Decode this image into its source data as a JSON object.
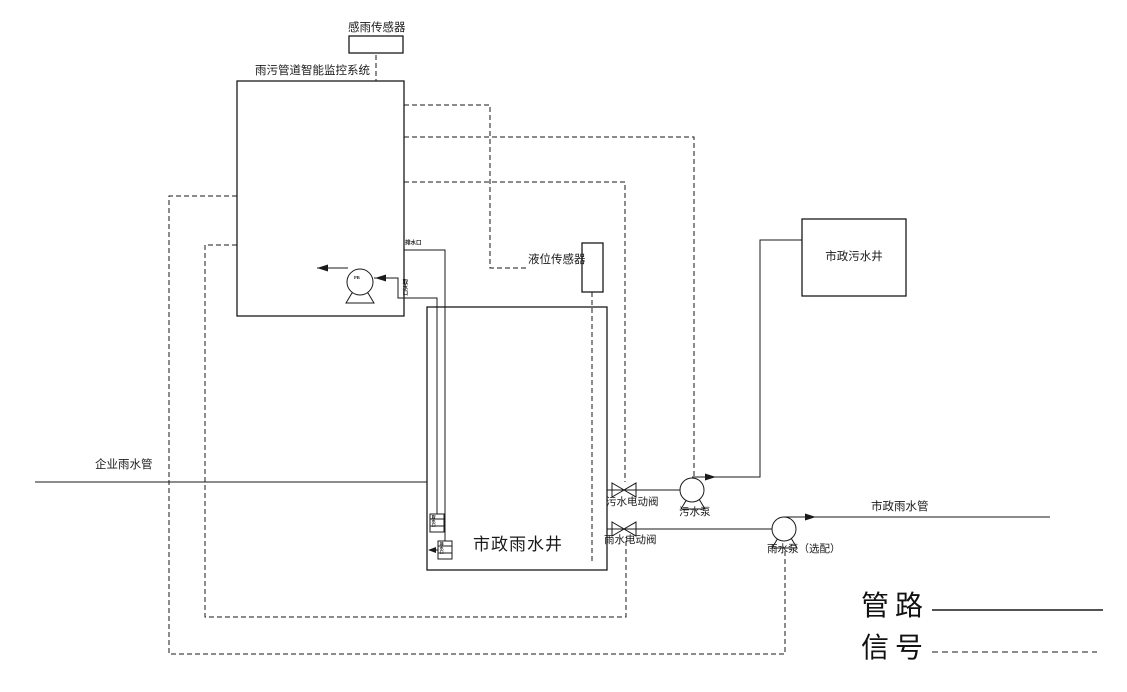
{
  "diagram": {
    "title": "雨污管道智能监控系统",
    "colors": {
      "line": "#1a1a1a",
      "background": "#ffffff"
    }
  },
  "labels": {
    "rain_sensor": "感雨传感器",
    "system_box": "雨污管道智能监控系统",
    "level_sensor": "液位传感器",
    "sewage_well": "市政污水井",
    "rain_well": "市政雨水井",
    "enterprise_rain_pipe": "企业雨水管",
    "sewage_valve": "污水电动阀",
    "sewage_pump": "污水泵",
    "rain_valve": "雨水电动阀",
    "rain_pump": "雨水泵（选配）",
    "municipal_rain_pipe": "市政雨水管",
    "outlet_port": "排水口",
    "intake_port": "取水口",
    "pump_tag": "PB",
    "strainer_upper": "取水口",
    "strainer_lower": "排水口"
  },
  "legend": {
    "pipeline_label": "管路",
    "pipeline_style": "solid",
    "signal_label": "信号",
    "signal_style": "dashed"
  }
}
